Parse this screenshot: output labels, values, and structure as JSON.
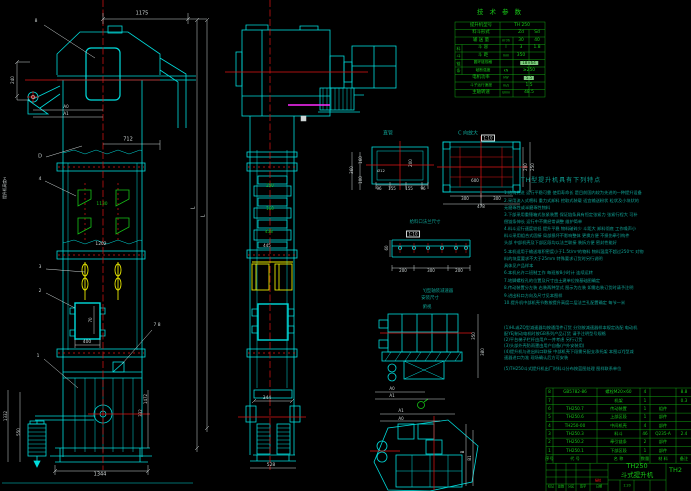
{
  "colors": {
    "w": "#cfd6d6",
    "cy": "#00dcdc",
    "r": "#e01414",
    "g": "#17c517",
    "y": "#e6e600",
    "teal": "#0fa396",
    "m": "#ff2bff",
    "hl": "#7fc97f"
  },
  "tech_table": {
    "title": "技 术 参 数",
    "cells": [
      {
        "t": "提升机型号",
        "x": 481,
        "y": 26,
        "c": "g"
      },
      {
        "t": "TH 250",
        "x": 522,
        "y": 26,
        "c": "g"
      },
      {
        "t": "料斗形式",
        "x": 481,
        "y": 33,
        "c": "g"
      },
      {
        "t": "Zd",
        "x": 521,
        "y": 33,
        "c": "g"
      },
      {
        "t": "Sd",
        "x": 537,
        "y": 33,
        "c": "g"
      },
      {
        "t": "输 送 量",
        "x": 481,
        "y": 41,
        "c": "g"
      },
      {
        "t": "m³/h",
        "x": 506,
        "y": 41,
        "c": "g",
        "s": 3.4
      },
      {
        "t": "30",
        "x": 521,
        "y": 41,
        "c": "g"
      },
      {
        "t": "40",
        "x": 537,
        "y": 41,
        "c": "g"
      },
      {
        "t": "料",
        "x": 458.5,
        "y": 48.5,
        "c": "g",
        "s": 4
      },
      {
        "t": "斗",
        "x": 458.5,
        "y": 56,
        "c": "g",
        "s": 4
      },
      {
        "t": "斗 容",
        "x": 483,
        "y": 48.2,
        "c": "g"
      },
      {
        "t": "l",
        "x": 506,
        "y": 48.2,
        "c": "g"
      },
      {
        "t": "3",
        "x": 521,
        "y": 48.2,
        "c": "g"
      },
      {
        "t": "1.8",
        "x": 537,
        "y": 48.2,
        "c": "g"
      },
      {
        "t": "斗 距",
        "x": 483,
        "y": 55.8,
        "c": "g"
      },
      {
        "t": "mm",
        "x": 506,
        "y": 55.8,
        "c": "g",
        "s": 3.4
      },
      {
        "t": "350",
        "x": 521,
        "y": 55.8,
        "c": "g"
      },
      {
        "t": "链",
        "x": 458.5,
        "y": 63.5,
        "c": "g",
        "s": 4
      },
      {
        "t": "条",
        "x": 458.5,
        "y": 71,
        "c": "g",
        "s": 4
      },
      {
        "t": "圆环链规格",
        "x": 483,
        "y": 63.2,
        "c": "g",
        "s": 3.7
      },
      {
        "t": "18×64",
        "x": 529,
        "y": 63.2,
        "hl": 1,
        "s": 4
      },
      {
        "t": "破断强度",
        "x": 483,
        "y": 70.8,
        "c": "g",
        "s": 3.7
      },
      {
        "t": "kN",
        "x": 506,
        "y": 70.8,
        "c": "g",
        "s": 3.4
      },
      {
        "t": "≥250",
        "x": 529,
        "y": 70.8,
        "c": "g"
      },
      {
        "t": "电机功率",
        "x": 481,
        "y": 78.2,
        "c": "g"
      },
      {
        "t": "kW",
        "x": 506,
        "y": 78.2,
        "c": "g",
        "s": 3.4
      },
      {
        "t": "5.5",
        "x": 529,
        "y": 78.2,
        "hl": 1,
        "s": 4
      },
      {
        "t": "斗子运行速度",
        "x": 481,
        "y": 85.8,
        "c": "g",
        "s": 3.7
      },
      {
        "t": "m/s",
        "x": 506,
        "y": 85.8,
        "c": "g",
        "s": 3.4
      },
      {
        "t": "1.5",
        "x": 529,
        "y": 85.8,
        "c": "g"
      },
      {
        "t": "主轴转速",
        "x": 481,
        "y": 93.2,
        "c": "g"
      },
      {
        "t": "r/min",
        "x": 506,
        "y": 93.2,
        "c": "g",
        "s": 3.2
      },
      {
        "t": "48.5",
        "x": 529,
        "y": 93.2,
        "c": "g"
      }
    ]
  },
  "notes": {
    "title": "TH型提升机具有下列特点",
    "x": 504,
    "lines": [
      {
        "y": 193,
        "t": "1.结构先进 运行平稳可靠 使用寿命长 是目前国内较为先进的一种提升设备"
      },
      {
        "y": 200.5,
        "t": "2.采用流入式喂料 重力式卸料 挖取式装载 适宜输送粉状 粒状及小块状的"
      },
      {
        "y": 207.5,
        "t": "  无磨琢性或半磨琢性物料"
      },
      {
        "y": 214.5,
        "t": "3.下部采用重锤箱式张紧装置 保证链条具有恒定张紧力 张紧行程大 可补"
      },
      {
        "y": 221.5,
        "t": "  偿链条伸长 运行中不需经常调整 维护简单"
      },
      {
        "y": 229,
        "t": "4.料斗运行速度较低 提升平稳 物料破碎少 斗距大 卸料彻底 工作噪声小"
      },
      {
        "y": 236,
        "t": "  料斗采用组合式固接 局部损坏不影响整体 更换方便 不损伤牵引构件"
      },
      {
        "y": 243,
        "t": "  头部 中部机壳及下部区段均以法兰联接 装拆方便 密封性能好"
      },
      {
        "y": 252,
        "t": "5.本机适用于输送堆积密度小于1.5t/m³的物料 物料温度不超过250℃ 对物"
      },
      {
        "y": 259,
        "t": "  料的块度要求不大于25mm          特殊要求订货时另行说明"
      },
      {
        "y": 266,
        "t": "  具体见产品样本"
      },
      {
        "y": 273,
        "t": "6.本机允许二班制工作 每班按8小时计 连续运转"
      },
      {
        "y": 281,
        "t": "7.地脚螺栓孔的位置及尺寸由土建单位按基础图确定"
      },
      {
        "y": 288,
        "t": "8.传动装置分左装 右装两种型式 图示为左装 如需右装订货时请予注明"
      },
      {
        "y": 295.5,
        "t": "9.进出料口方向及尺寸见本图样"
      },
      {
        "y": 303,
        "t": "10.提升机中部机壳节数按提升高度二层法兰孔配置确定 每节一米"
      },
      {
        "y": 328,
        "t": "(1)HL或ZQ型减速器均按通用件订货 分别按减速器样本规定选配 电动机"
      },
      {
        "y": 334,
        "t": "  配YEJ制动电机时按GB系列产品订货 请予注明型号规格"
      },
      {
        "y": 340,
        "t": "(2)平台梯子栏杆由用户一并考虑 另行订货"
      },
      {
        "y": 346,
        "t": "(3)头部外壳防雨罩由用户自备(户外安装用)"
      },
      {
        "y": 352,
        "t": "(4)提升机与进出料口联接 中部机壳下段需另配支承托架 本图以YJ型减"
      },
      {
        "y": 358,
        "t": "  速器进口为准 现场确认后方可安装"
      },
      {
        "y": 369,
        "t": "(5)TH250斗式提升机出厂时料斗分布按蓝图处理 图样联系单位"
      }
    ]
  },
  "bom": {
    "cols": [
      549.5,
      575,
      618.5,
      645,
      663,
      684
    ],
    "row_y": [
      392.2,
      400.6,
      408.9,
      417.2,
      425.6,
      433.9,
      442.3,
      450.6
    ],
    "header_y": 459,
    "header": [
      "序号",
      "代  号",
      "名  称",
      "数量",
      "材 料",
      "备注"
    ],
    "rows": [
      [
        "8",
        "GB5782-86",
        "螺栓M20×60",
        "4",
        "",
        "8.8"
      ],
      [
        "7",
        "",
        "机架",
        "1",
        "",
        "0.3"
      ],
      [
        "6",
        "TH250.7",
        "传动装置",
        "1",
        "组件",
        ""
      ],
      [
        "5",
        "TH250.6",
        "上部区段",
        "1",
        "部件",
        ""
      ],
      [
        "4",
        "TH250-00",
        "中间机壳",
        "4",
        "部件",
        ""
      ],
      [
        "3",
        "TH250.3",
        "料斗",
        "46",
        "Q235-A",
        "2.4"
      ],
      [
        "2",
        "TH250.2",
        "牵引链条",
        "2",
        "部件",
        ""
      ],
      [
        "1",
        "TH250.1",
        "下部区段",
        "1",
        "部件",
        ""
      ]
    ]
  },
  "title_block": {
    "model": "TH250",
    "name": "斗式提升机",
    "dwg": "TH2",
    "scale": "1:20",
    "small_labels": [
      {
        "t": "标记",
        "x": 551,
        "y": 487,
        "c": "g",
        "s": 3.2
      },
      {
        "t": "处数",
        "x": 561,
        "y": 487,
        "c": "g",
        "s": 3.2
      },
      {
        "t": "分区",
        "x": 571,
        "y": 487,
        "c": "g",
        "s": 3.2
      },
      {
        "t": "签字",
        "x": 583,
        "y": 487,
        "c": "g",
        "s": 3.2
      },
      {
        "t": "日期",
        "x": 599,
        "y": 487,
        "c": "g",
        "s": 3.2
      },
      {
        "t": "描校",
        "x": 598,
        "y": 481,
        "c": "r",
        "s": 3.2
      },
      {
        "t": "1:20",
        "x": 627,
        "y": 486,
        "c": "g",
        "s": 3.4
      }
    ]
  },
  "annotations": {
    "left_view": [
      {
        "t": "8",
        "x": 36,
        "y": 22
      },
      {
        "t": "1175",
        "x": 142,
        "y": 14,
        "s": 5
      },
      {
        "t": "240",
        "x": 13,
        "y": 80,
        "r": 1,
        "s": 4
      },
      {
        "t": "A0",
        "x": 66,
        "y": 107,
        "s": 4
      },
      {
        "t": "A1",
        "x": 66,
        "y": 114,
        "s": 4
      },
      {
        "t": "D",
        "x": 40,
        "y": 157,
        "s": 5
      },
      {
        "t": "712",
        "x": 128,
        "y": 140,
        "s": 5
      },
      {
        "t": "4",
        "x": 40,
        "y": 180
      },
      {
        "t": "1130",
        "x": 102,
        "y": 205,
        "c": "g"
      },
      {
        "t": "1202",
        "x": 101,
        "y": 245
      },
      {
        "t": "3",
        "x": 40,
        "y": 268
      },
      {
        "t": "2",
        "x": 40,
        "y": 292
      },
      {
        "t": "70",
        "x": 91,
        "y": 320,
        "r": 1,
        "s": 4
      },
      {
        "t": "400",
        "x": 87,
        "y": 343
      },
      {
        "t": "7 8",
        "x": 157,
        "y": 326
      },
      {
        "t": "1",
        "x": 38,
        "y": 357
      },
      {
        "t": "提升机高度H",
        "x": 5,
        "y": 188,
        "r": 1,
        "s": 3.8
      },
      {
        "t": "1332",
        "x": 6,
        "y": 416,
        "r": 1,
        "s": 4
      },
      {
        "t": "550",
        "x": 19,
        "y": 432,
        "r": 1,
        "s": 4
      },
      {
        "t": "1472",
        "x": 146,
        "y": 399,
        "r": 1,
        "s": 4
      },
      {
        "t": "332",
        "x": 141,
        "y": 413,
        "r": 1,
        "s": 4
      },
      {
        "t": "1344",
        "x": 100,
        "y": 475,
        "s": 5
      },
      {
        "t": "L",
        "x": 194,
        "y": 208,
        "r": 1,
        "s": 5
      },
      {
        "t": "L",
        "x": 204,
        "y": 216,
        "r": 1,
        "s": 5
      }
    ],
    "middle_view": [
      {
        "t": "250",
        "x": 270,
        "y": 186,
        "c": "g",
        "s": 4
      },
      {
        "t": "160",
        "x": 270,
        "y": 209,
        "c": "g",
        "s": 4
      },
      {
        "t": "438",
        "x": 269,
        "y": 232,
        "c": "g",
        "s": 4
      },
      {
        "t": "445",
        "x": 267,
        "y": 246,
        "s": 4
      },
      {
        "t": "360",
        "x": 352,
        "y": 170,
        "r": 1,
        "s": 4
      },
      {
        "t": "160",
        "x": 361,
        "y": 160,
        "r": 1,
        "s": 4
      },
      {
        "t": "100",
        "x": 361,
        "y": 180,
        "r": 1,
        "s": 4
      },
      {
        "t": "344",
        "x": 267,
        "y": 399,
        "s": 4.4
      },
      {
        "t": "528",
        "x": 271,
        "y": 466,
        "s": 4.4
      }
    ],
    "details": [
      {
        "t": "直管",
        "x": 388,
        "y": 134,
        "c": "teal",
        "s": 5
      },
      {
        "t": "Ø12",
        "x": 381,
        "y": 171,
        "s": 3.8
      },
      {
        "t": "200",
        "x": 411,
        "y": 163,
        "r": 1,
        "s": 4
      },
      {
        "t": "96",
        "x": 379,
        "y": 189,
        "s": 4
      },
      {
        "t": "155",
        "x": 392,
        "y": 189,
        "s": 4
      },
      {
        "t": "155",
        "x": 409,
        "y": 189,
        "s": 4
      },
      {
        "t": "96",
        "x": 423,
        "y": 189,
        "s": 4
      },
      {
        "t": "C 向放大",
        "x": 468,
        "y": 134,
        "c": "teal",
        "s": 5
      },
      {
        "t": "1:10",
        "x": 488,
        "y": 138,
        "s": 4,
        "box": 1
      },
      {
        "t": "600",
        "x": 475,
        "y": 181,
        "s": 4
      },
      {
        "t": "300",
        "x": 465,
        "y": 199,
        "s": 4
      },
      {
        "t": "300",
        "x": 497,
        "y": 199,
        "s": 4
      },
      {
        "t": "478",
        "x": 481,
        "y": 207,
        "s": 4
      },
      {
        "t": "200",
        "x": 526,
        "y": 167,
        "r": 1,
        "s": 4
      },
      {
        "t": "250",
        "x": 533,
        "y": 167,
        "r": 1,
        "s": 4
      },
      {
        "t": "给料口法兰尺寸",
        "x": 425,
        "y": 223,
        "c": "teal",
        "s": 4.4
      },
      {
        "t": "1:10",
        "x": 413,
        "y": 234,
        "s": 4,
        "box": 1
      },
      {
        "t": "60",
        "x": 387,
        "y": 248,
        "r": 1,
        "s": 4
      },
      {
        "t": "200",
        "x": 403,
        "y": 271,
        "s": 4
      },
      {
        "t": "300",
        "x": 431,
        "y": 271,
        "s": 4
      },
      {
        "t": "200",
        "x": 459,
        "y": 271,
        "s": 4
      }
    ],
    "drive_plan": [
      {
        "t": "YJ型轴装减速器",
        "x": 438,
        "y": 292,
        "c": "teal",
        "s": 4.4
      },
      {
        "t": "安装尺寸",
        "x": 430,
        "y": 299,
        "c": "teal",
        "s": 4.4
      },
      {
        "t": "俯视",
        "x": 427,
        "y": 308,
        "c": "teal",
        "s": 4.4
      },
      {
        "t": "350",
        "x": 474,
        "y": 336,
        "r": 1,
        "s": 4
      },
      {
        "t": "380",
        "x": 483,
        "y": 352,
        "r": 1,
        "s": 4
      },
      {
        "t": "A0",
        "x": 392,
        "y": 389,
        "s": 4
      },
      {
        "t": "A1",
        "x": 392,
        "y": 396,
        "s": 4
      },
      {
        "t": "A1",
        "x": 401,
        "y": 411,
        "s": 4
      },
      {
        "t": "A0",
        "x": 401,
        "y": 419,
        "s": 4
      },
      {
        "t": "B",
        "x": 463,
        "y": 452,
        "r": 1,
        "s": 4
      },
      {
        "t": "B1",
        "x": 470,
        "y": 458,
        "r": 1,
        "s": 4
      }
    ]
  }
}
